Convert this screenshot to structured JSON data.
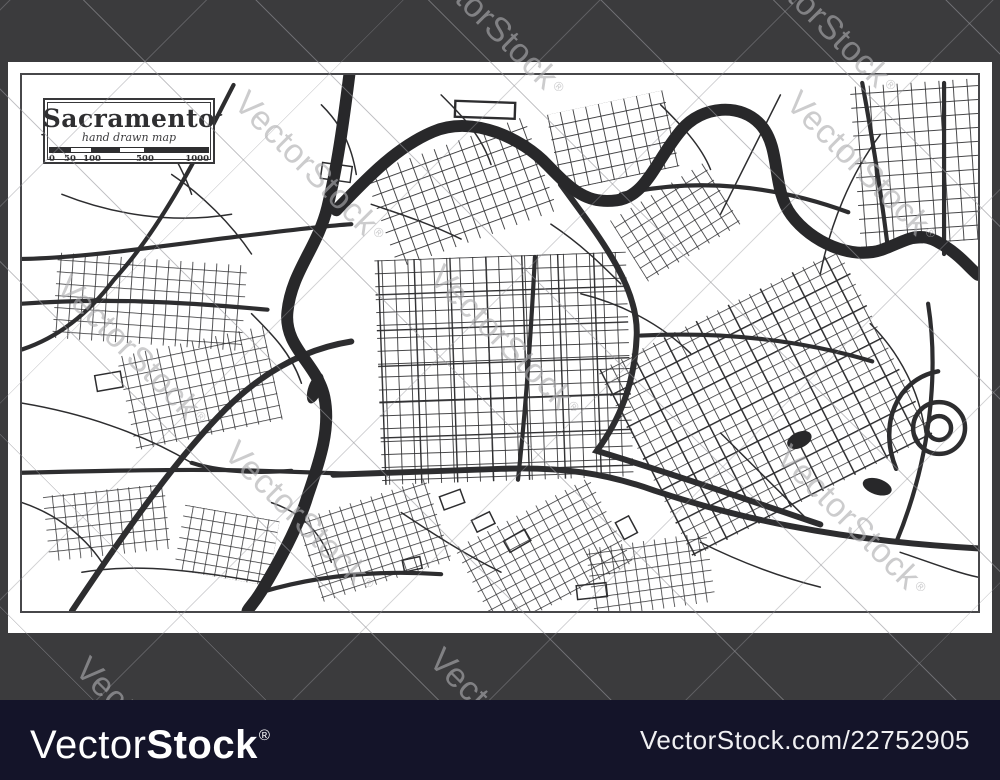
{
  "map_card": {
    "title": "Sacramento",
    "subtitle": "hand drawn map",
    "scale_labels": [
      "0",
      "50",
      "100",
      "500",
      "1000"
    ]
  },
  "watermark": {
    "text": "VectorStock",
    "reg": "®"
  },
  "footer": {
    "brand_light": "Vector",
    "brand_bold": "Stock",
    "reg": "®",
    "image_url": "VectorStock.com/22752905"
  },
  "colors": {
    "frame_gray": "#3b3b3d",
    "footer_navy": "#141429",
    "map_ink": "#2d2d2f",
    "river_ink": "#28282a",
    "sheet_white": "#ffffff",
    "watermark_gray": "#adadb0"
  }
}
